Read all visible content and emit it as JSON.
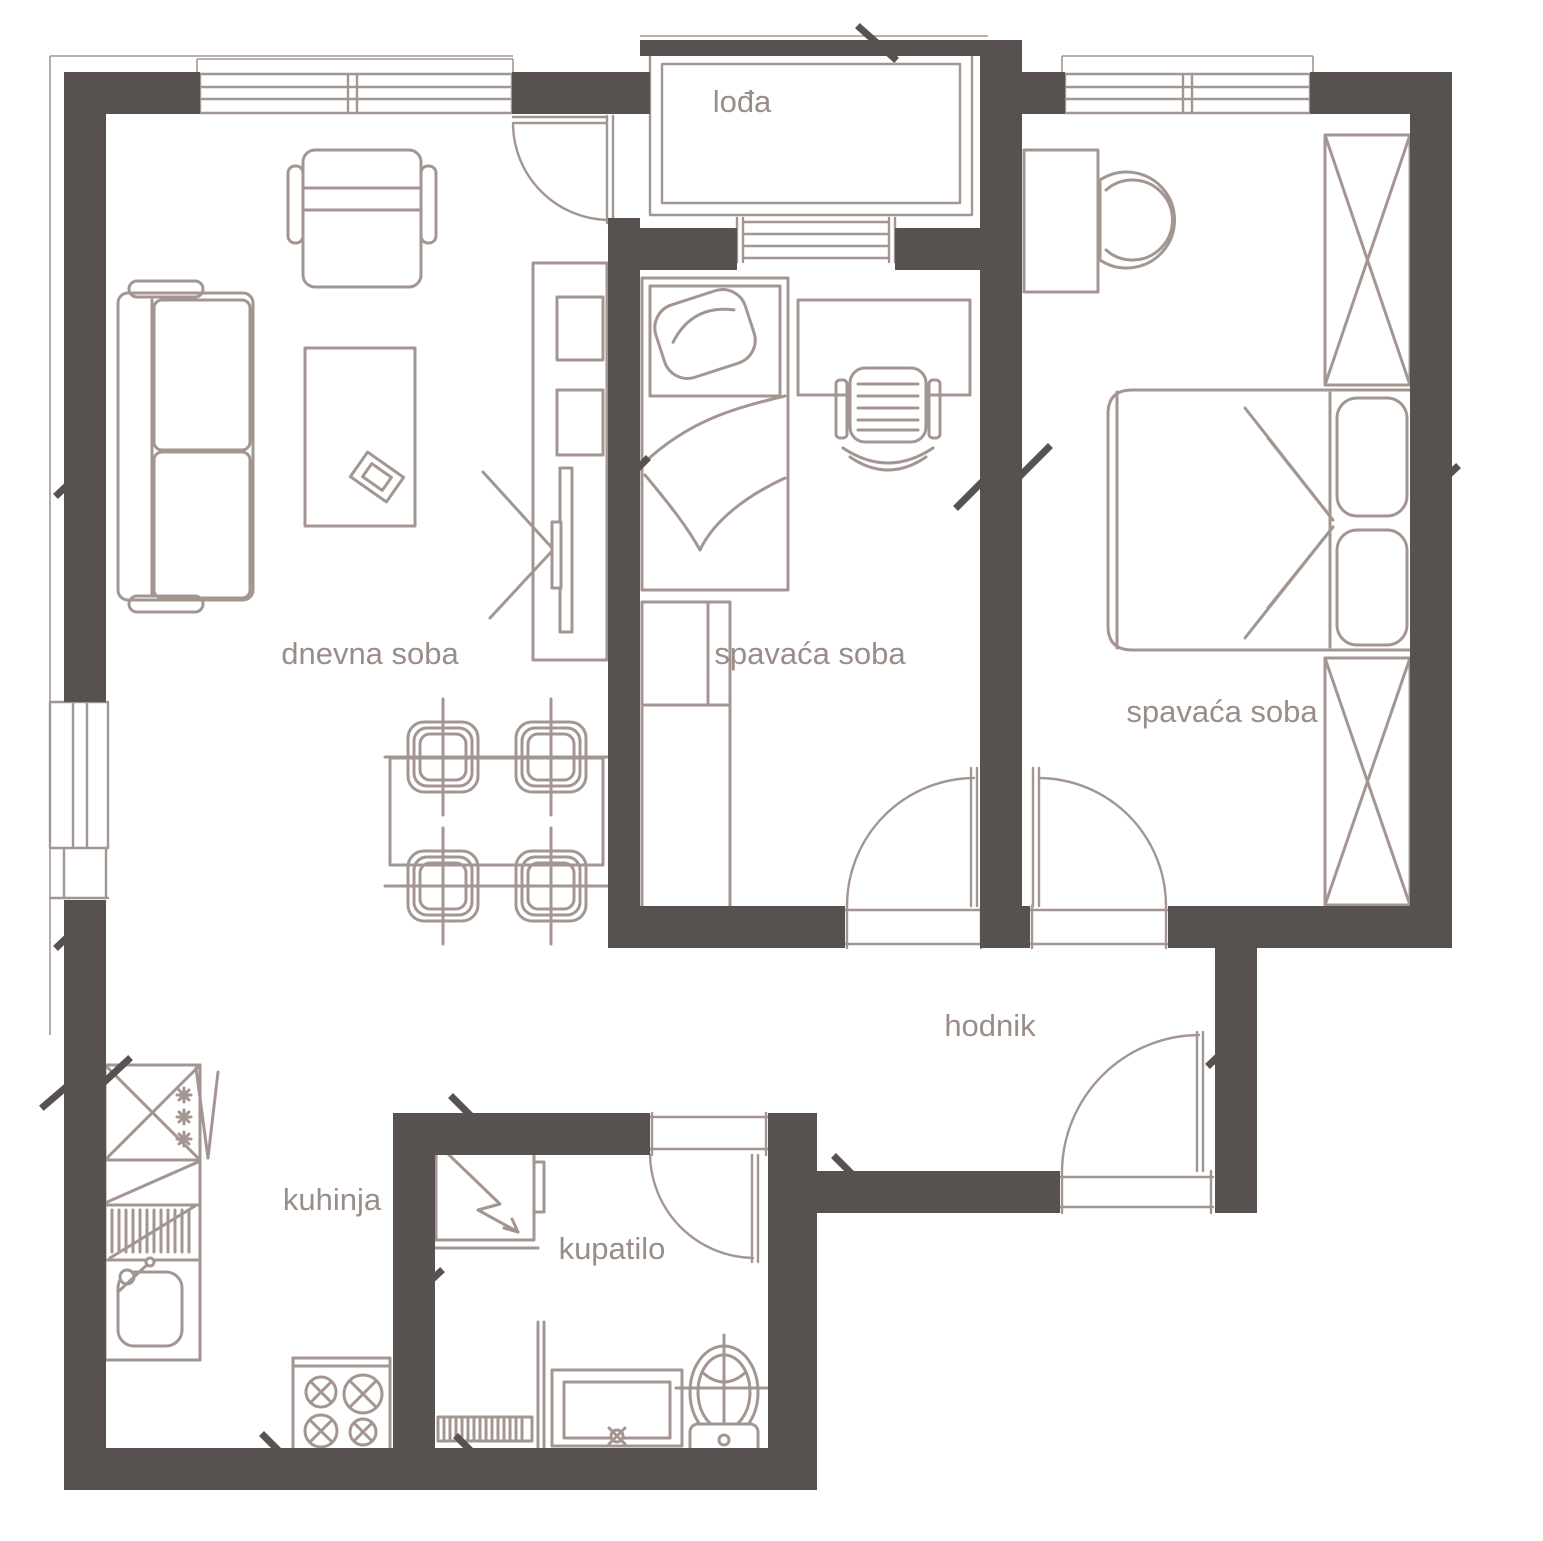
{
  "colors": {
    "wall": "#575150",
    "line": "#a39691",
    "text": "#9a8d88",
    "background": "#ffffff"
  },
  "rooms": {
    "loggia": {
      "label": "lođa"
    },
    "living": {
      "label": "dnevna soba"
    },
    "bedroom1": {
      "label": "spavaća soba"
    },
    "bedroom2": {
      "label": "spavaća soba"
    },
    "hallway": {
      "label": "hodnik"
    },
    "kitchen": {
      "label": "kuhinja"
    },
    "bathroom": {
      "label": "kupatilo"
    }
  }
}
